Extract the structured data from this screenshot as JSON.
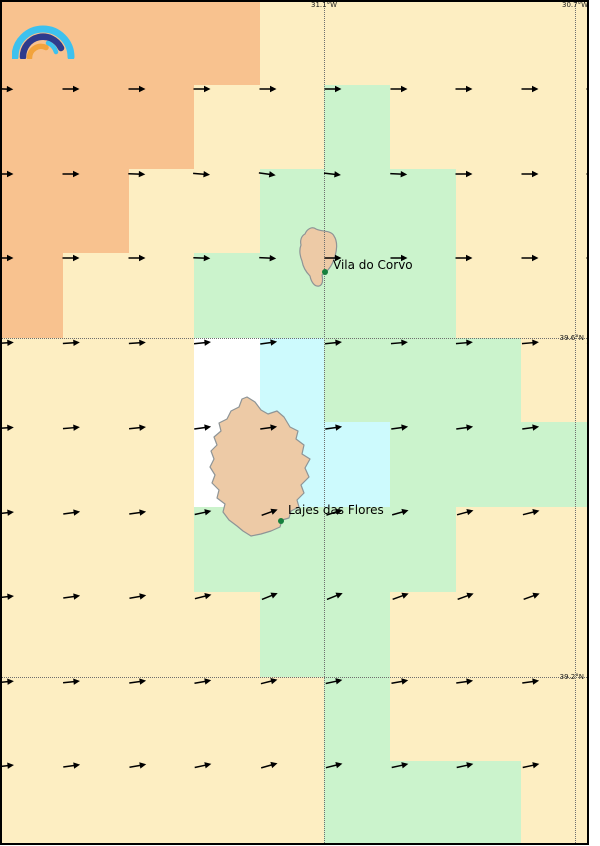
{
  "map": {
    "frame_color": "#000000",
    "page_background": "#ffffff",
    "palette": {
      "O": "#f8c28f",
      "C": "#fdeec2",
      "G": "#cbf3cc",
      "B": "#cdfafd",
      "W": "#ffffff"
    },
    "grid": {
      "col_edges": [
        0,
        63,
        129,
        194,
        260,
        324,
        390,
        456,
        521,
        586,
        600
      ],
      "row_edges": [
        0,
        85,
        169,
        253,
        338,
        422,
        507,
        592,
        677,
        761,
        846
      ],
      "cells": [
        "OOOOCCCCCC",
        "OOOCCGCCCC",
        "OOCCGGGCCC",
        "OCCGGGGCCC",
        "CCCWBGGGCC",
        "CCCWBBGGGG",
        "CCCGGGGCCC",
        "CCCCGGCCCC",
        "CCCCCGCCCC",
        "CCCCCGGGCC"
      ]
    },
    "graticule": {
      "line_color": "#6e6e6e",
      "label_color": "#1a1a1a",
      "meridians": [
        {
          "label": "31.1°W",
          "x": 324
        },
        {
          "label": "30.7°W",
          "x": 575
        }
      ],
      "parallels": [
        {
          "label": "39.6°N",
          "y": 338
        },
        {
          "label": "39.2°N",
          "y": 677
        }
      ]
    },
    "wind": {
      "color": "#000000",
      "x": [
        4,
        70,
        136,
        201,
        267,
        332,
        398,
        463,
        529,
        594
      ],
      "y": [
        84,
        169,
        253,
        338,
        423,
        508,
        592,
        677,
        761,
        843
      ],
      "angles_deg": [
        [
          2,
          0,
          0,
          0,
          0,
          0,
          0,
          0,
          0,
          0
        ],
        [
          0,
          0,
          2,
          5,
          8,
          6,
          3,
          0,
          0,
          0
        ],
        [
          0,
          0,
          0,
          2,
          3,
          0,
          0,
          0,
          0,
          0
        ],
        [
          -4,
          -4,
          -4,
          -6,
          -8,
          -6,
          -5,
          -5,
          -5,
          -5
        ],
        [
          -4,
          -5,
          -6,
          -8,
          -8,
          -8,
          -8,
          -8,
          -8,
          -8
        ],
        [
          -6,
          -8,
          -8,
          -12,
          -20,
          -18,
          -16,
          -15,
          -14,
          -14
        ],
        [
          -6,
          -8,
          -10,
          -14,
          -22,
          -22,
          -20,
          -20,
          -20,
          -20
        ],
        [
          -5,
          -6,
          -8,
          -10,
          -14,
          -12,
          -10,
          -8,
          -8,
          -8
        ],
        [
          -6,
          -8,
          -10,
          -12,
          -16,
          -14,
          -12,
          -12,
          -12,
          -12
        ],
        [
          -12,
          -14,
          -14,
          -16,
          -20,
          -18,
          -15,
          -13,
          -13,
          -13
        ]
      ]
    },
    "islands": [
      {
        "name": "corvo-island",
        "fill": "#edcaa6",
        "stroke": "#8e9496",
        "path": "M 316,229 C 312,226 307,229 305,234 C 301,236 300,241 301,245 C 299,250 300,256 302,261 C 303,267 306,272 310,276 C 311,281 314,287 319,286 C 323,285 323,280 322,275 C 327,272 332,266 334,259 C 337,251 338,242 334,236 C 331,230 322,232 316,229 Z"
      },
      {
        "name": "flores-island",
        "fill": "#edcaa6",
        "stroke": "#8e9496",
        "path": "M 247,397 L 255,402 L 261,410 L 268,414 L 277,411 L 284,417 L 290,427 L 298,431 L 296,439 L 304,445 L 302,454 L 310,459 L 305,468 L 309,477 L 301,485 L 304,493 L 297,500 L 299,507 L 291,511 L 289,518 L 282,520 L 280,527 L 271,531 L 261,534 L 251,536 L 243,531 L 237,526 L 229,520 L 223,512 L 225,504 L 217,498 L 219,490 L 212,483 L 215,475 L 210,467 L 214,459 L 211,451 L 217,445 L 214,437 L 221,431 L 219,423 L 227,419 L 231,411 L 239,407 L 242,399 Z"
      }
    ],
    "places": [
      {
        "label": "Vila do Corvo",
        "marker_color": "#15803d",
        "marker_x": 325,
        "marker_y": 272,
        "label_x": 333,
        "label_y": 258
      },
      {
        "label": "Lajes das Flores",
        "marker_color": "#15803d",
        "marker_x": 281,
        "marker_y": 521,
        "label_x": 288,
        "label_y": 503
      }
    ],
    "logo": {
      "colors": {
        "outer": "#3ec1ee",
        "middle": "#2e3a8c",
        "inner_blue": "#3ec1ee",
        "inner": "#f2a33c"
      }
    }
  }
}
